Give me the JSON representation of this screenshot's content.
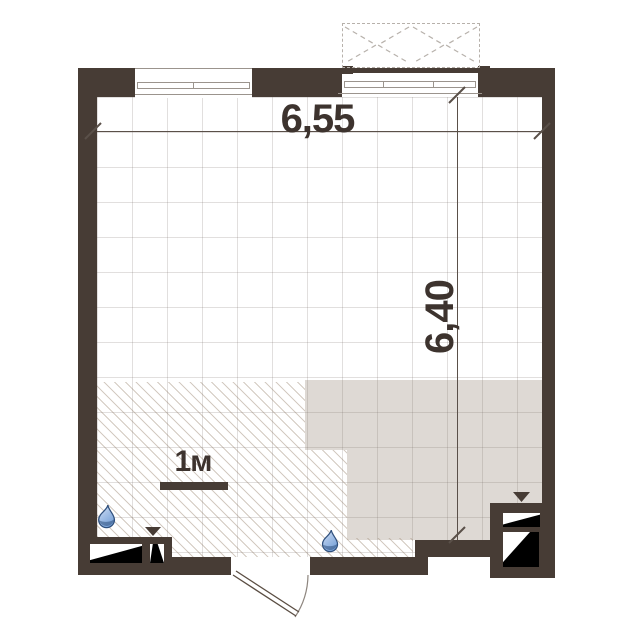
{
  "plan": {
    "type": "floor-plan",
    "room": {
      "width_label": "6,55",
      "height_label": "6,40"
    },
    "scale_bar": {
      "label": "1м"
    },
    "colors": {
      "wall": "#473c35",
      "tile": "#ded9d4",
      "text": "#3d332e",
      "dim": "#5a5049",
      "arc": "#8d857e",
      "win": "#9b948d",
      "drop-dark": "#30507d",
      "drop-mid": "#78a2d8",
      "drop-light": "#eef4fc"
    },
    "icons": {
      "plumbing_point": "water-drop-icon",
      "vent_direction": "triangle-down-icon",
      "vent_shaft": "vent-shaft-wedge-icon",
      "balcony_glazing": "dashed-casement-icon"
    }
  }
}
